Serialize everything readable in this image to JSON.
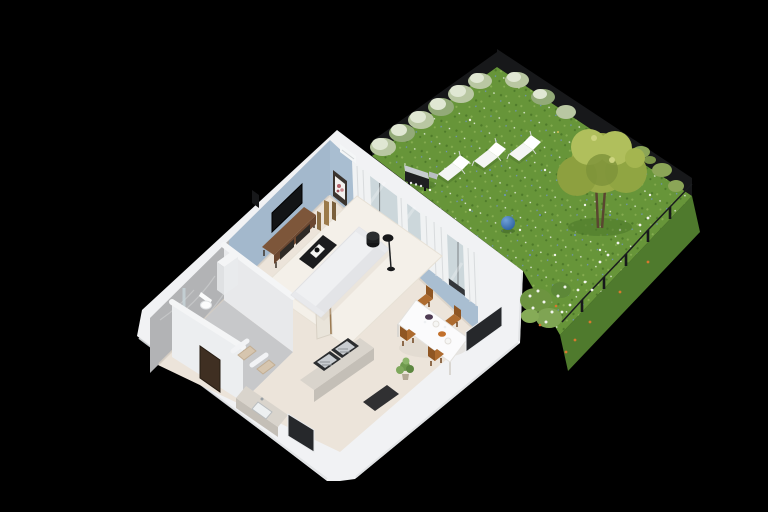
{
  "scene": {
    "type": "isometric-3d-floor-plan",
    "description": "3D cutaway floor plan of a small apartment with living room, dining area, kitchen, bathroom, hallway and a private fenced garden with lawn, tree, deck chairs and barbecue",
    "background": "#000000"
  },
  "colors": {
    "background": "#000000",
    "lawn": "#679539",
    "lawnShadow": "#50792e",
    "lawnSlope": "#4f7a2d",
    "fenceDark": "#17181a",
    "bushSage": "#b9c7a2",
    "bushLight": "#e0e7d3",
    "bushDeep": "#93aa78",
    "tallGrass": "#8ba557",
    "treeCanopy": "#9aab48",
    "treeCanopyLight": "#b0bf5c",
    "treeCanopyShade": "#7d923a",
    "treeTrunk": "#5a4630",
    "deckChair": "#f4f5f4",
    "grillBody": "#1e1f21",
    "grillLid": "#c7ccd0",
    "ballBlue": "#2a5f9e",
    "ballBlueLight": "#6fa0d8",
    "wallWhite": "#f1f2f4",
    "wallShade": "#e7e9eb",
    "accentBlueNW": "#a3b8cc",
    "accentBlueNE": "#a9bed1",
    "marble": "#b2b3b5",
    "floorBeige": "#ece4da",
    "rug": "#f4f0e9",
    "bathFloor": "#c7c8ca",
    "glass": "#ccd7db",
    "curtain": "#f0f2f3",
    "trackDark": "#33363a",
    "wood": "#7d563a",
    "woodDark": "#6b4730",
    "drawerDark": "#2e2a26",
    "tvBlack": "#121416",
    "sofa": "#eff0f2",
    "sofaShade": "#e3e4e7",
    "tableBlack": "#1b1c1e",
    "tableWhite": "#fbfbfc",
    "chairTan": "#ad6b2f",
    "chairTanDark": "#8f5623",
    "counter": "#d9d4cc",
    "cabinet": "#c4bfb7",
    "applianceFrame": "#2b2d2f",
    "applianceSteel": "#c9cdd1",
    "mat": "#202124",
    "doorBrown": "#3f2f22",
    "windowDark": "#26282b",
    "vanityWhite": "#f4f5f6",
    "partition": "#eceef0",
    "bronze": "#8a6c42",
    "plantGreen": "#6f9a4e",
    "flowerWhite": "#f2f5ee",
    "flowerOrange": "#d9782e",
    "bowlPlum": "#4e3b52",
    "bowlOrange": "#c2702b",
    "toiletWhite": "#fbfcfc"
  },
  "apartment": {
    "rooms": [
      {
        "name": "living-room",
        "items": [
          "sofa",
          "rug",
          "coffee-table",
          "tv",
          "media-console",
          "decor-vases",
          "floor-lamp",
          "speaker",
          "ottoman",
          "wall-art",
          "air-conditioner",
          "curtains",
          "sliding-glass-doors"
        ]
      },
      {
        "name": "dining-area",
        "items": [
          "dining-table",
          "dining-chairs",
          "bowls",
          "plates",
          "potted-plant",
          "window"
        ]
      },
      {
        "name": "kitchen",
        "items": [
          "peninsula-counter",
          "built-in-cooktops",
          "sink-counter",
          "floor-mat",
          "window",
          "partition-fin"
        ]
      },
      {
        "name": "bathroom",
        "items": [
          "toilet",
          "shower-glass",
          "vanity-cabinet",
          "marble-walls"
        ]
      },
      {
        "name": "hallway",
        "items": [
          "entrance-door",
          "closet-shelves"
        ]
      }
    ],
    "counts": {
      "dining_chairs": 4
    }
  },
  "garden": {
    "items": [
      "lawn",
      "deck-chairs",
      "bbq-grill",
      "tree",
      "blue-ball",
      "shrubs",
      "wildflowers",
      "mesh-fence"
    ],
    "counts": {
      "deck_chairs": 3,
      "fence_posts": 10
    }
  }
}
